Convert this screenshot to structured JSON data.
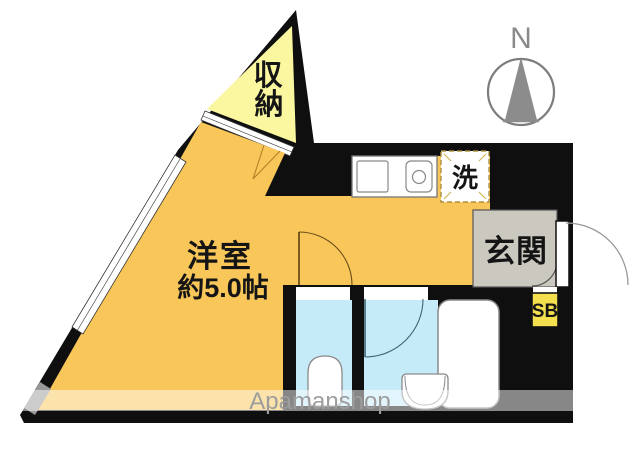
{
  "plan": {
    "type_note": "floor-plan",
    "storage": {
      "label": "収納",
      "chars": [
        "収",
        "納"
      ]
    },
    "main_room": {
      "name": "洋室",
      "size": "約5.0帖"
    },
    "laundry": {
      "label": "洗"
    },
    "entrance": {
      "label": "玄関"
    },
    "shoebox": {
      "label": "SB"
    }
  },
  "compass": {
    "label": "N"
  },
  "watermark": {
    "text": "Apamanshop"
  },
  "colors": {
    "wall": "#0f0f0f",
    "main_room": "#f8c659",
    "storage": "#faf7a0",
    "wet_area": "#c6ebf8",
    "entrance": "#cbc8c0",
    "shoebox": "#f4e04e",
    "fixture_stroke": "#8a8a8a",
    "compass": "#8c8c8c"
  }
}
